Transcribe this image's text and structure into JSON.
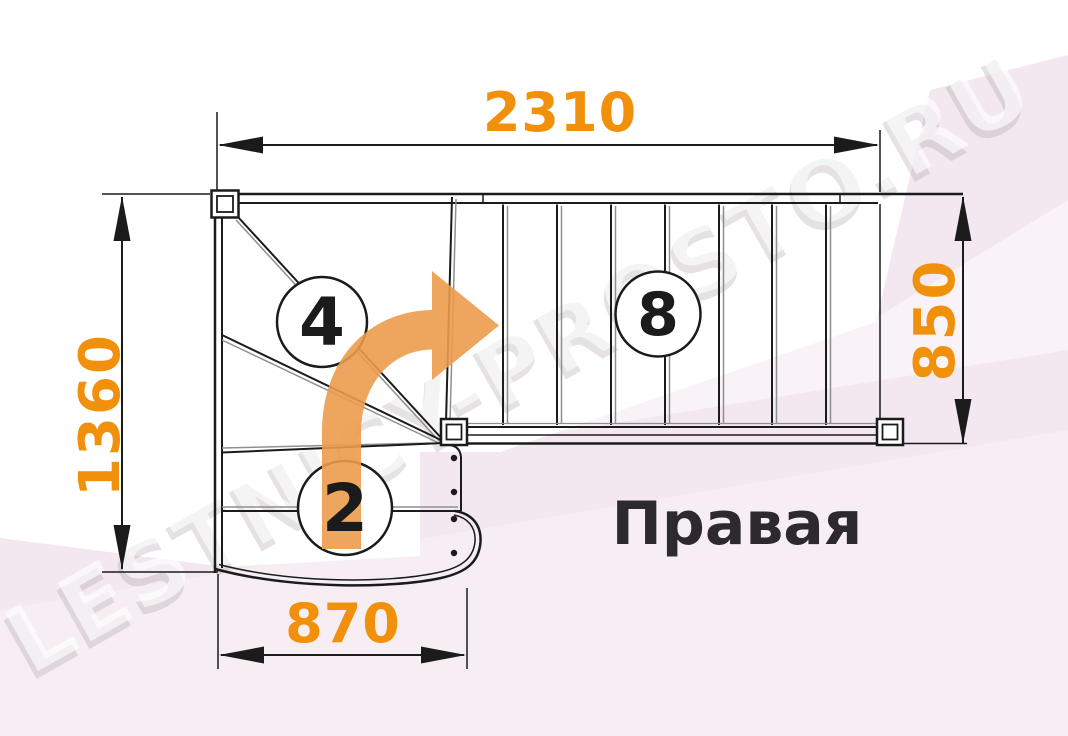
{
  "diagram": {
    "title": "Правая",
    "watermark": "LESTNICY-PROSTO.RU",
    "dimensions": {
      "top": {
        "value": "2310"
      },
      "left": {
        "value": "1360"
      },
      "right": {
        "value": "850"
      },
      "bottom": {
        "value": "870"
      }
    },
    "step_counts": {
      "winder_flight": "4",
      "upper_flight": "8",
      "lower_flight": "2"
    },
    "colors": {
      "dimension_text": "#F1900A",
      "arrow_fill": "#EC9B4B",
      "line": "#1B1B1B",
      "line_gray": "#8F8F8F",
      "background_pink": "#F3E8EF",
      "title_text": "#2D2A2E"
    }
  }
}
